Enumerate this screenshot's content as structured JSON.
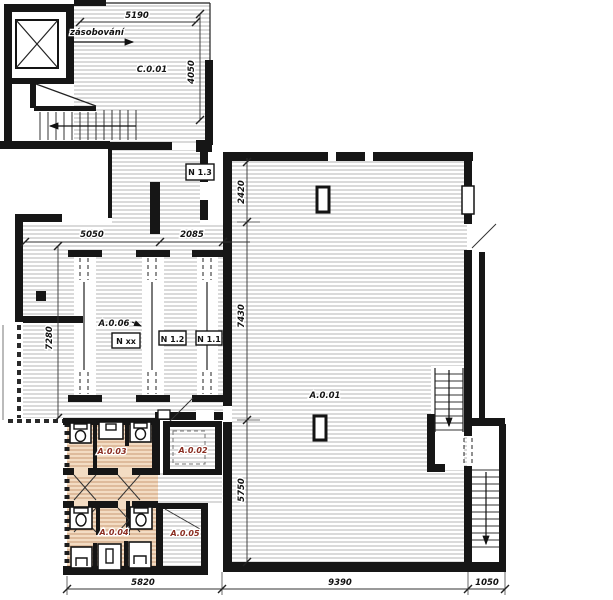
{
  "plan": {
    "room_labels": {
      "c001": "C.0.01",
      "a001": "A.0.01",
      "a002": "A.0.02",
      "a003": "A.0.03",
      "a004": "A.0.04",
      "a005": "A.0.05",
      "a006": "A.0.06"
    },
    "door_labels": {
      "n13": "N 1.3",
      "nxx": "N xx",
      "n12": "N 1.2",
      "n11": "N 1.1"
    },
    "annotations": {
      "supply_arrow": "zásobování"
    },
    "dimensions": {
      "d5190": "5190",
      "d4050": "4050",
      "d5050": "5050",
      "d2085": "2085",
      "d7280": "7280",
      "d2420": "2420",
      "d7430": "7430",
      "d5750": "5750",
      "d5820": "5820",
      "d9390": "9390",
      "d1050": "1050"
    },
    "colors": {
      "wall": "#161616",
      "hatch_line": "#b5b5b5",
      "tan_fill": "#f3dcc3",
      "tan_hatch_line": "#c89a74",
      "room_label_red": "#8b2e22",
      "dim_text": "#111111"
    }
  }
}
